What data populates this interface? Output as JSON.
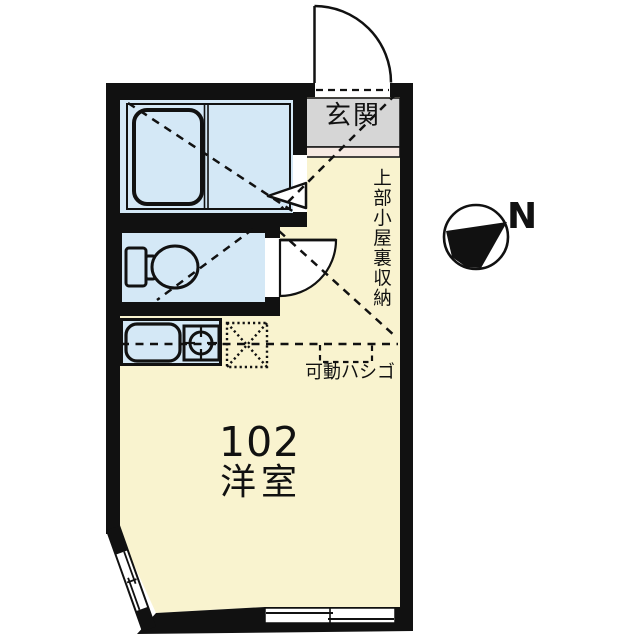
{
  "plan": {
    "unit_number": "102",
    "main_room_label": "洋室",
    "entrance_label": "玄関",
    "attic_storage_label": "上部小屋裏収納",
    "movable_ladder_label": "可動ハシゴ",
    "north_label": "N",
    "colors": {
      "background": "#ffffff",
      "wall": "#111111",
      "floor": "#f9f3cf",
      "wet_area": "#d4e8f6",
      "entrance_floor": "#d6d6d6",
      "entrance_step": "#f6e9e2"
    },
    "fixtures": [
      "bathtub",
      "toilet",
      "kitchen-sink",
      "single-burner-stove"
    ],
    "features": [
      "entrance-door-swing",
      "bathroom-folding-door",
      "toilet-door-swing",
      "attic-storage-dashed-area",
      "movable-ladder-position",
      "corner-window",
      "bottom-window",
      "north-compass"
    ]
  }
}
